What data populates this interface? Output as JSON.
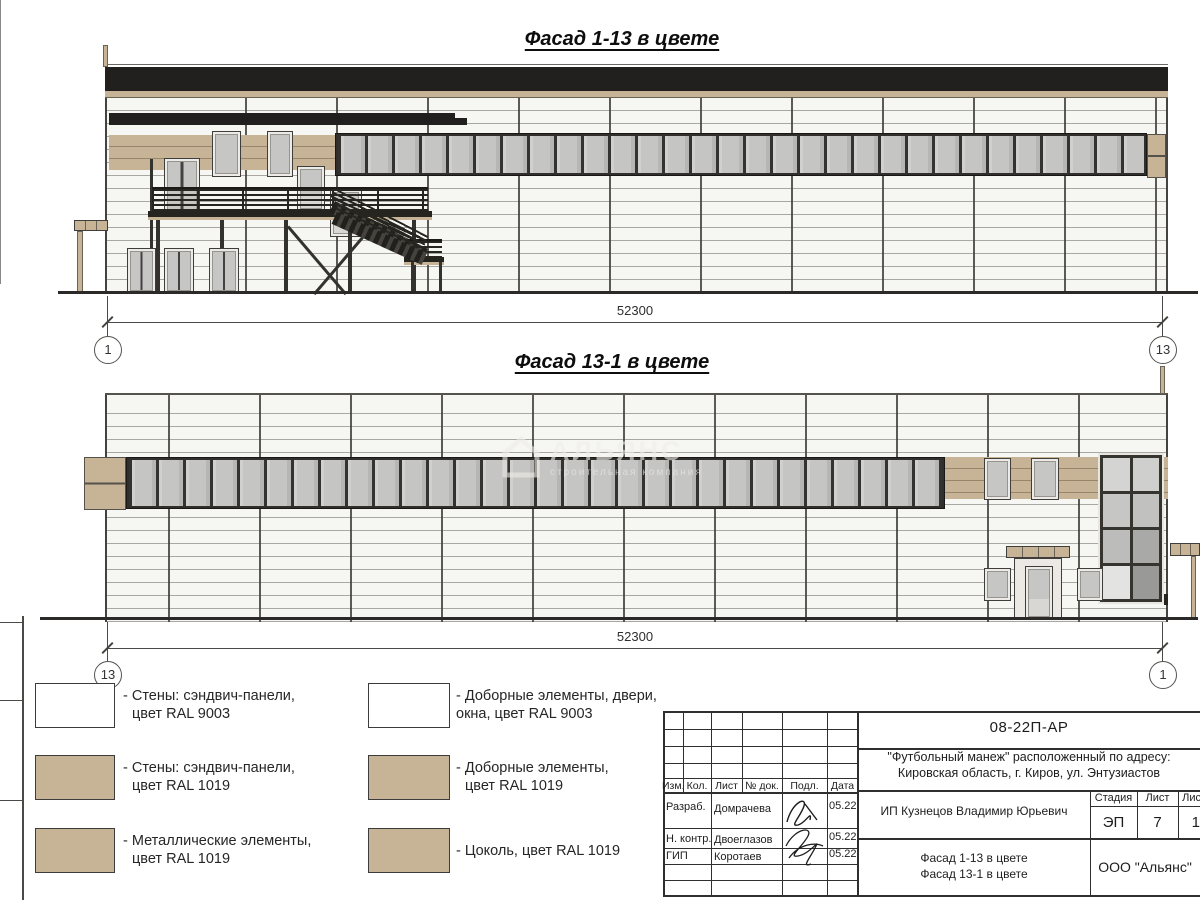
{
  "watermark": {
    "name": "АЛЬЯНС",
    "subtitle": "строительная компания"
  },
  "facade_top": {
    "title": "Фасад 1-13 в цвете",
    "dim": "52300",
    "axis_left": "1",
    "axis_right": "13"
  },
  "facade_bottom": {
    "title": "Фасад 13-1 в цвете",
    "dim": "52300",
    "axis_left": "13",
    "axis_right": "1"
  },
  "legend": {
    "items": [
      {
        "swatch": "#ffffff",
        "line1": "- Стены: сэндвич-панели,",
        "line2": "цвет RAL 9003"
      },
      {
        "swatch": "#c7b396",
        "line1": "- Стены: сэндвич-панели,",
        "line2": "цвет RAL 1019"
      },
      {
        "swatch": "#c7b396",
        "line1": "- Металлические элементы,",
        "line2": "цвет RAL 1019"
      },
      {
        "swatch": "#ffffff",
        "line1": "- Доборные элементы, двери,",
        "line2": "окна, цвет RAL 9003"
      },
      {
        "swatch": "#c7b396",
        "line1": "- Доборные элементы,",
        "line2": "цвет RAL 1019"
      },
      {
        "swatch": "#c7b396",
        "line1": "- Цоколь, цвет RAL 1019",
        "line2": ""
      }
    ]
  },
  "titleblock": {
    "doc_number": "08-22П-АР",
    "project_line1": "\"Футбольный манеж\" расположенный по адресу:",
    "project_line2": "Кировская область, г. Киров, ул. Энтузиастов",
    "cols": {
      "izm": "Изм.",
      "kol": "Кол.",
      "list": "Лист",
      "doc": "№ док.",
      "podp": "Подл.",
      "data": "Дата"
    },
    "rows": [
      {
        "role": "Разраб.",
        "name": "Домрачева",
        "date": "05.22"
      },
      {
        "role": "Н. контр.",
        "name": "Двоеглазов",
        "date": "05.22"
      },
      {
        "role": "ГИП",
        "name": "Коротаев",
        "date": "05.22"
      }
    ],
    "client": "ИП Кузнецов Владимир Юрьевич",
    "stage_label": "Стадия",
    "sheet_label": "Лист",
    "sheets_label": "Листов",
    "stage": "ЭП",
    "sheet": "7",
    "sheets": "17",
    "drawing_line1": "Фасад 1-13 в цвете",
    "drawing_line2": "Фасад 13-1 в цвете",
    "org": "ООО \"Альянс\""
  },
  "colors": {
    "tan": "#c7b396",
    "band_black": "#21201e",
    "glass": "#c5c5c4",
    "panel_white": "#f6f6f3"
  }
}
